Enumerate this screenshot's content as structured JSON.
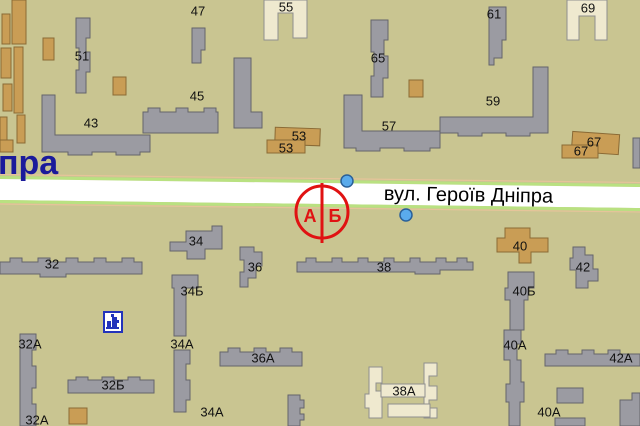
{
  "map": {
    "street_name": "вул. Героїв Дніпра",
    "street_fragment": "пра",
    "metro_marker": {
      "letter_left": "А",
      "letter_right": "Б"
    },
    "metro_exits": [
      {
        "x": 347,
        "y": 181
      },
      {
        "x": 406,
        "y": 215
      }
    ],
    "building_labels": [
      {
        "t": "47",
        "x": 198,
        "y": 11
      },
      {
        "t": "51",
        "x": 82,
        "y": 56
      },
      {
        "t": "55",
        "x": 286,
        "y": 7
      },
      {
        "t": "45",
        "x": 197,
        "y": 96
      },
      {
        "t": "43",
        "x": 91,
        "y": 123
      },
      {
        "t": "65",
        "x": 378,
        "y": 58
      },
      {
        "t": "61",
        "x": 494,
        "y": 14
      },
      {
        "t": "69",
        "x": 588,
        "y": 8
      },
      {
        "t": "59",
        "x": 493,
        "y": 101
      },
      {
        "t": "57",
        "x": 389,
        "y": 126
      },
      {
        "t": "53",
        "x": 299,
        "y": 136
      },
      {
        "t": "53",
        "x": 286,
        "y": 148
      },
      {
        "t": "67",
        "x": 594,
        "y": 142
      },
      {
        "t": "67",
        "x": 581,
        "y": 151
      },
      {
        "t": "34",
        "x": 196,
        "y": 241
      },
      {
        "t": "32",
        "x": 52,
        "y": 264
      },
      {
        "t": "34Б",
        "x": 192,
        "y": 291
      },
      {
        "t": "36",
        "x": 255,
        "y": 267
      },
      {
        "t": "38",
        "x": 384,
        "y": 267
      },
      {
        "t": "40",
        "x": 520,
        "y": 246
      },
      {
        "t": "42",
        "x": 583,
        "y": 267
      },
      {
        "t": "40Б",
        "x": 524,
        "y": 291
      },
      {
        "t": "32А",
        "x": 30,
        "y": 344
      },
      {
        "t": "34А",
        "x": 182,
        "y": 344
      },
      {
        "t": "36А",
        "x": 263,
        "y": 358
      },
      {
        "t": "38А",
        "x": 404,
        "y": 391
      },
      {
        "t": "40А",
        "x": 515,
        "y": 345
      },
      {
        "t": "42А",
        "x": 621,
        "y": 358
      },
      {
        "t": "32Б",
        "x": 113,
        "y": 385
      },
      {
        "t": "32А",
        "x": 37,
        "y": 420
      },
      {
        "t": "34А",
        "x": 212,
        "y": 412
      },
      {
        "t": "40А",
        "x": 549,
        "y": 412
      }
    ],
    "colors": {
      "background": "#c9c591",
      "building_gray": "#9b9ba2",
      "building_tan": "#c99d55",
      "building_cream": "#efe9cf",
      "road_fill": "#ffffff",
      "road_edge_green": "#b9e181",
      "metro_red": "#e01212",
      "exit_dot_blue": "#5aabec",
      "street_text": "#000000",
      "street_fragment_blue": "#1b1b9b"
    },
    "icons": [
      {
        "name": "landmark-icon"
      }
    ]
  }
}
